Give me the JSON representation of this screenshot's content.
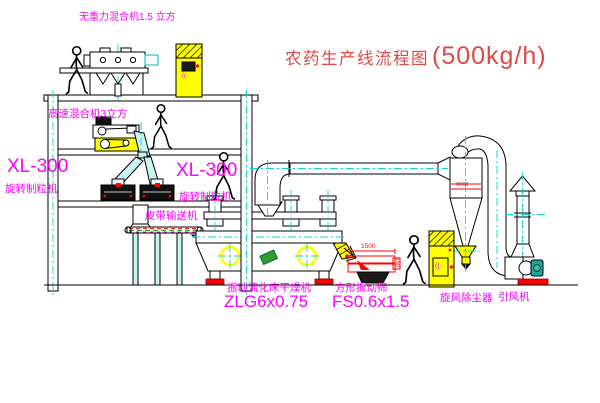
{
  "colors": {
    "magenta": "#ff00ff",
    "title_red": "#e04848",
    "cad_red": "#ff0000",
    "yellow": "#ffff00",
    "cyan": "#00d8d8",
    "green": "#00a000",
    "teal_motor": "#18a99e"
  },
  "title": {
    "text": "农药生产线流程图",
    "capacity": "(500kg/h)"
  },
  "labels": {
    "gravity_mixer": "无重力混合机1.5 立方",
    "high_speed_mixer": "高速混合机3立方",
    "granulator_model_left": "XL-300",
    "granulator_name_left": "旋转制粒机",
    "granulator_model_right": "XL-300",
    "granulator_name_right": "旋转制粒机",
    "belt_conveyor": "皮带输送机",
    "dryer_name": "振动流化床干燥机",
    "dryer_model": "ZLG6x0.75",
    "screen_name": "方形振动筛",
    "screen_model": "FS0.6x1.5",
    "cyclone_name": "旋风除尘器",
    "fan_name": "引风机"
  },
  "dimensions": {
    "screen_length": "1500",
    "screen_outlet_height": "550",
    "cyclone_diameter": "Φ600"
  },
  "cabinet_glyphs": {
    "top": "((·",
    "right": "((·"
  }
}
